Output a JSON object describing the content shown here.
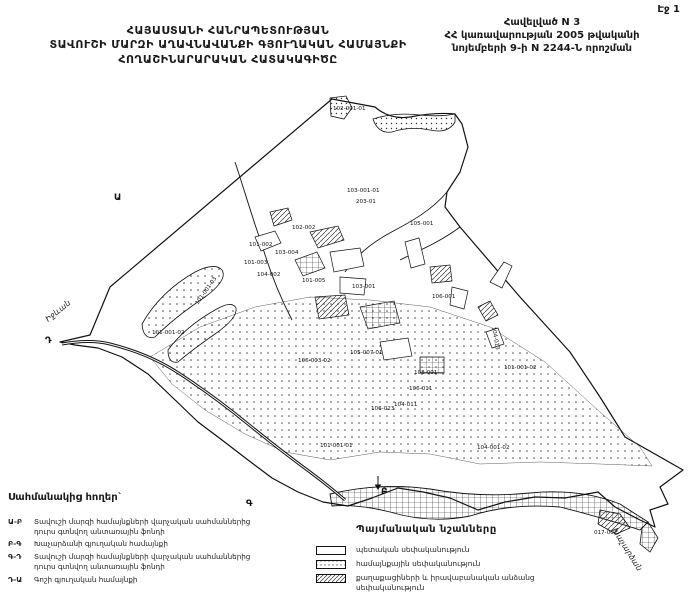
{
  "page": {
    "page_label": "Էջ 1"
  },
  "header": {
    "title_lines": [
      "ՀԱՅԱՍՏԱՆԻ ՀԱՆՐԱՊԵՏՈՒԹՅԱՆ",
      "ՏԱՎՈՒՇԻ ՄԱՐԶԻ ԱՂԱՎՆԱՎԱՆՔԻ ԳՅՈՒՂԱԿԱՆ ՀԱՄԱՅՆՔԻ",
      "ՀՈՂԱՇԻՆԱՐԱՐԱԿԱՆ ՀԱՏԱԿԱԳԻԾԸ"
    ],
    "appendix_lines": [
      "Հավելված N 3",
      "ՀՀ կառավարության 2005 թվականի",
      "նոյեմբերի 9-ի N 2244-Ն որոշման"
    ]
  },
  "map": {
    "parcel_labels": [
      {
        "text": "102-001-01",
        "x": 333,
        "y": 18,
        "rot": 0
      },
      {
        "text": "103-001-01",
        "x": 347,
        "y": 100,
        "rot": 0
      },
      {
        "text": "203-01",
        "x": 356,
        "y": 111,
        "rot": 0
      },
      {
        "text": "105-001",
        "x": 410,
        "y": 133,
        "rot": 0
      },
      {
        "text": "102-002",
        "x": 292,
        "y": 137,
        "rot": 0
      },
      {
        "text": "101-002",
        "x": 249,
        "y": 154,
        "rot": 0
      },
      {
        "text": "103-004",
        "x": 275,
        "y": 162,
        "rot": 0
      },
      {
        "text": "101-003",
        "x": 244,
        "y": 172,
        "rot": 0
      },
      {
        "text": "104-002",
        "x": 257,
        "y": 184,
        "rot": 0
      },
      {
        "text": "101-005",
        "x": 302,
        "y": 190,
        "rot": 0
      },
      {
        "text": "103-001",
        "x": 352,
        "y": 196,
        "rot": 0
      },
      {
        "text": "106-001",
        "x": 432,
        "y": 206,
        "rot": 0
      },
      {
        "text": "101-001-03",
        "x": 198,
        "y": 213,
        "rot": -55
      },
      {
        "text": "101-001-02",
        "x": 152,
        "y": 242,
        "rot": 0
      },
      {
        "text": "105-007-01",
        "x": 350,
        "y": 262,
        "rot": 0
      },
      {
        "text": "106-003-02",
        "x": 298,
        "y": 270,
        "rot": 0
      },
      {
        "text": "108-001",
        "x": 414,
        "y": 282,
        "rot": 0
      },
      {
        "text": "106-011",
        "x": 409,
        "y": 298,
        "rot": 0
      },
      {
        "text": "104-011",
        "x": 394,
        "y": 314,
        "rot": 0
      },
      {
        "text": "106-023",
        "x": 371,
        "y": 318,
        "rot": 0
      },
      {
        "text": "104-013",
        "x": 492,
        "y": 235,
        "rot": 80
      },
      {
        "text": "101-001-02",
        "x": 504,
        "y": 277,
        "rot": 0
      },
      {
        "text": "101-001-01",
        "x": 320,
        "y": 355,
        "rot": 0
      },
      {
        "text": "104-001-02",
        "x": 477,
        "y": 357,
        "rot": 0
      },
      {
        "text": "017-002",
        "x": 594,
        "y": 442,
        "rot": 0
      }
    ],
    "corner_letters": [
      {
        "letter": "Ա",
        "x": 114,
        "y": 108
      },
      {
        "letter": "Բ",
        "x": 381,
        "y": 402
      },
      {
        "letter": "Գ",
        "x": 246,
        "y": 414
      },
      {
        "letter": "Դ",
        "x": 45,
        "y": 251
      }
    ],
    "direction_labels": [
      {
        "text": "Իջևան",
        "x": 48,
        "y": 230,
        "rot": -38
      },
      {
        "text": "Խաչարձան",
        "x": 612,
        "y": 438,
        "rot": 58
      }
    ]
  },
  "adjacent_lands": {
    "heading": "Սահմանակից հողեր`",
    "items": [
      {
        "code": "Ա-Բ",
        "text": "Տավուշի մարզի համայնքների վարչական սահմաններից դուրս գտնվող անտառային ֆոնդի"
      },
      {
        "code": "Բ-Գ",
        "text": "Խաչարձանի գյուղական համայնքի"
      },
      {
        "code": "Գ-Դ",
        "text": "Տավուշի մարզի համայնքների վարչական սահմաններից դուրս գտնվող անտառային ֆոնդի"
      },
      {
        "code": "Դ-Ա",
        "text": "Գոշի գյուղական համայնքի"
      }
    ]
  },
  "legend": {
    "heading": "Պայմանական նշանները",
    "items": [
      {
        "pattern": "blank",
        "label": "պետական սեփականություն"
      },
      {
        "pattern": "dots",
        "label": "համայնքային սեփականություն"
      },
      {
        "pattern": "hatch",
        "label": "քաղաքացիների և իրավաբանական անձանց սեփականություն"
      }
    ]
  },
  "colors": {
    "ink": "#1a1a1a",
    "paper": "#ffffff"
  }
}
